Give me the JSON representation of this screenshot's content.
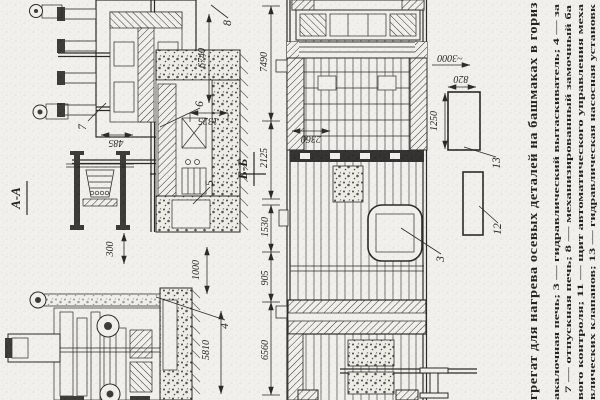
{
  "figure": {
    "section_labels": {
      "aa": "А-А",
      "bb": "Б-Б"
    },
    "dimensions": {
      "d7490": "7490",
      "d6740": "6740",
      "d1325": "1325",
      "d485": "485",
      "d2125": "2125",
      "d300": "300",
      "d2360": "2360",
      "d1250": "1250",
      "d3000": "~3000",
      "d820": "820",
      "d1530": "1530",
      "d905": "905",
      "d6560": "6560",
      "d1000": "1000",
      "d5810": "5810"
    },
    "part_labels": {
      "p3": "3",
      "p4": "4",
      "p5": "5",
      "p6": "6",
      "p7": "7",
      "p8": "8",
      "p12": "12",
      "p13": "13"
    }
  },
  "caption": {
    "title": "грегат для нагрева осевых деталей на башмаках в гориз",
    "lines": [
      "акалочная печь; 3 — гидравлический вытаскиватель; 4 — за",
      "7 — отпускная печь; 8 — механизированный замочный ба",
      "вого контроля; 11 — щит автоматического управления меха",
      "влических клапанов; 13 — гидравлическая насосная установк"
    ]
  },
  "colors": {
    "paper": "#f1f0ec",
    "ink": "#23221f"
  }
}
